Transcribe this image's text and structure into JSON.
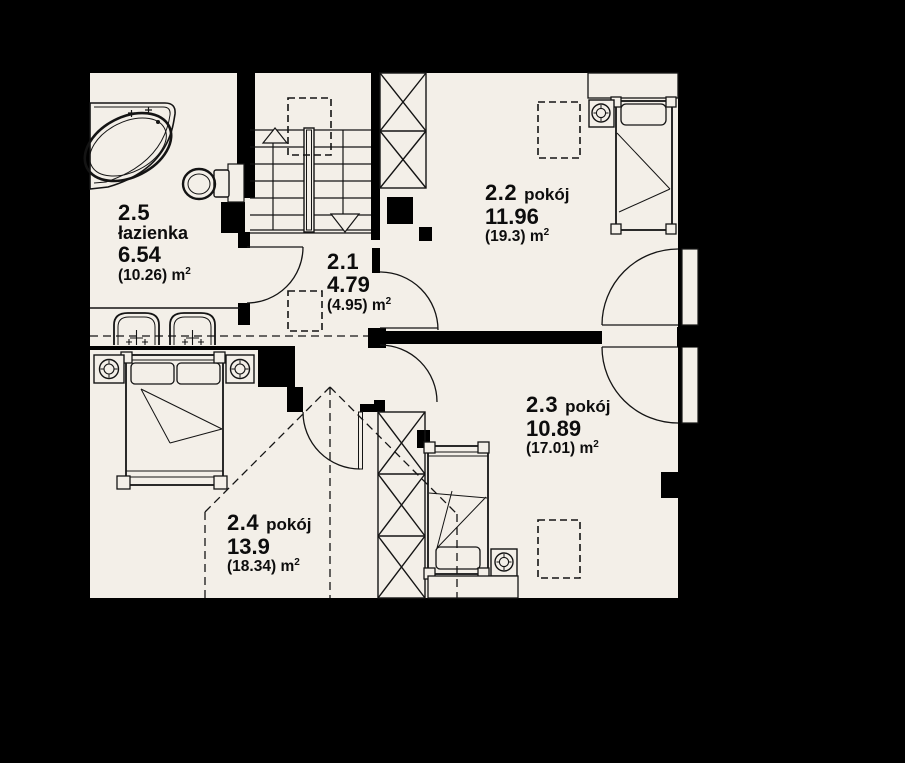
{
  "plan_title": "attic floor plan",
  "colors": {
    "background": "#000000",
    "floor": "#f3efe8",
    "line": "#141414",
    "wall": "#000000"
  },
  "rooms": [
    {
      "id": "2.1",
      "name": "",
      "area": "4.79",
      "gross": "(4.95)",
      "unit": "m",
      "sup": "2"
    },
    {
      "id": "2.2",
      "name": "pokój",
      "area": "11.96",
      "gross": "(19.3)",
      "unit": "m",
      "sup": "2"
    },
    {
      "id": "2.3",
      "name": "pokój",
      "area": "10.89",
      "gross": "(17.01)",
      "unit": "m",
      "sup": "2"
    },
    {
      "id": "2.4",
      "name": "pokój",
      "area": "13.9",
      "gross": "(18.34)",
      "unit": "m",
      "sup": "2"
    },
    {
      "id": "2.5",
      "name": "łazienka",
      "area": "6.54",
      "gross": "(10.26)",
      "unit": "m",
      "sup": "2"
    }
  ],
  "fixture_icons": [
    "corner-bathtub-icon",
    "toilet-icon",
    "double-washbasin-icon",
    "staircase-icon",
    "chimney-shaft-icon",
    "double-bed-icon",
    "single-bed-icon",
    "nightstand-lamp-icon",
    "wardrobe-shelf-icon",
    "roof-window-dashed-icon",
    "door-swing-icon",
    "roof-line-dashed-icon"
  ]
}
